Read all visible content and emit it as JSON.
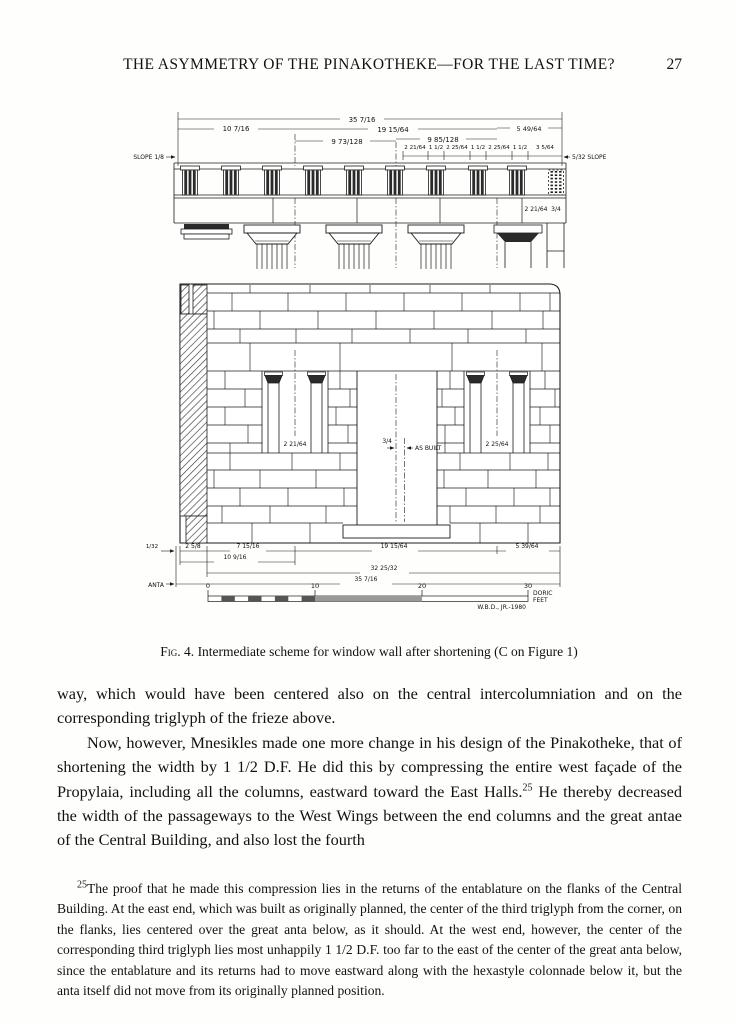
{
  "header": {
    "title": "THE ASYMMETRY OF THE PINAKOTHEKE—FOR THE LAST TIME?",
    "page_number": "27"
  },
  "figure": {
    "caption": {
      "label": "Fig. 4.",
      "text": " Intermediate scheme for window wall after shortening (C on Figure 1)"
    },
    "dims_top": {
      "overall": "35 7/16",
      "span_left": "10 7/16",
      "span_mid": "19 15/64",
      "span_right": "5 49/64",
      "bay_left": "9 73/128",
      "bay_right": "9 85/128",
      "small": [
        "2 21/64",
        "1 1/2",
        "2 25/64",
        "1 1/2",
        "2 25/64",
        "1 1/2",
        "3 5/64"
      ],
      "slope_left": "SLOPE 1/8",
      "slope_right": "5/32 SLOPE"
    },
    "architrave": {
      "dim_a": "2 21/64",
      "dim_b": "3/4"
    },
    "wall": {
      "window_left_dim": "2 21/64",
      "window_right_dim": "2 25/64",
      "door_offset_dim": "3/4",
      "as_built_label": "AS BUILT"
    },
    "dims_bottom": {
      "edge": "1/32",
      "anta_width": "2 5/8",
      "a": "7 15/16",
      "b": "19 15/64",
      "c": "5 39/64",
      "d": "10 9/16",
      "e": "32 25/32",
      "overall": "35 7/16",
      "anta_label": "ANTA"
    },
    "scale": {
      "ticks": [
        "0",
        "10",
        "20",
        "30"
      ],
      "unit_line1": "DORIC",
      "unit_line2": "FEET",
      "credit": "W.B.D., JR.-1980"
    }
  },
  "body": {
    "para1": "way, which would have been centered also on the central intercolumniation and on the corresponding triglyph of the frieze above.",
    "para2_a": "Now, however, Mnesikles made one more change in his design of the Pinakotheke, that of shortening the width by 1 1/2 D.F. He did this by compressing the entire west façade of the Propylaia, including all the columns, eastward toward the East Halls.",
    "para2_marker": "25",
    "para2_b": " He thereby decreased the width of the passageways to the West Wings between the end columns and the great antae of the Central Building, and also lost the fourth"
  },
  "footnote": {
    "marker": "25",
    "text": "The proof that he made this compression lies in the returns of the entablature on the flanks of the Central Building. At the east end, which was built as originally planned, the center of the third triglyph from the corner, on the flanks, lies centered over the great anta below, as it should. At the west end, however, the center of the corresponding third triglyph lies most unhappily 1 1/2 D.F. too far to the east of the center of the great anta below, since the entablature and its returns had to move eastward along with the hexastyle colonnade below it, but the anta itself did not move from its originally planned position."
  }
}
